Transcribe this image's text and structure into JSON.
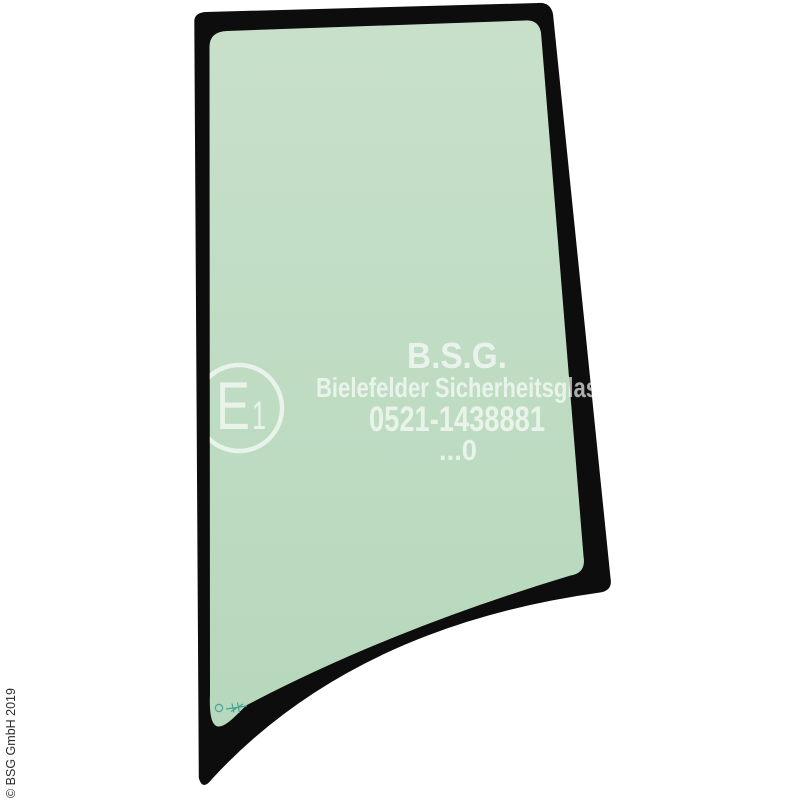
{
  "product_illustration": {
    "type": "vehicle-door-glass",
    "glass_print": {
      "brand": "B.S.G.",
      "manufacturer": "Bielefelder Sicherheitsglas",
      "phone": "0521-1438881",
      "code": "...0"
    },
    "e_mark": {
      "letter": "E",
      "number": "1"
    },
    "copyright": "© BSG GmbH 2019"
  },
  "colors": {
    "background": "#ffffff",
    "frame": "#0d0d0d",
    "glass_top": "#c8e0ca",
    "glass_bottom": "#b6d8bc",
    "print": "#ffffff",
    "stamp": "#3a9a8e",
    "copyright_text": "#2b2b2b"
  }
}
